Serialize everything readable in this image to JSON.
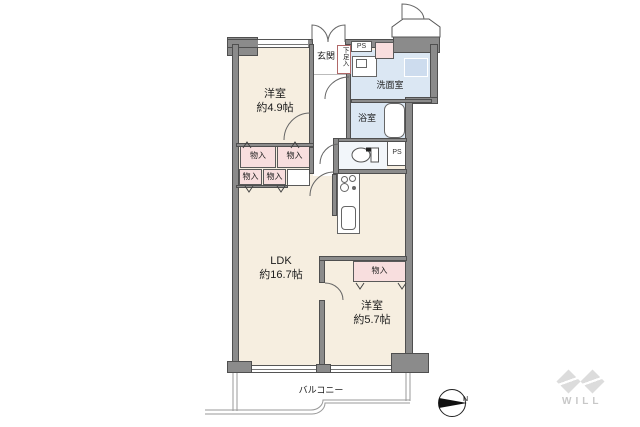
{
  "labels": {
    "room1_name": "洋室",
    "room1_size": "約4.9帖",
    "ldk_name": "LDK",
    "ldk_size": "約16.7帖",
    "room2_name": "洋室",
    "room2_size": "約5.7帖",
    "genkan": "玄関",
    "shoe_box": "下足入",
    "washroom": "洗面室",
    "bathroom": "浴室",
    "storage": "物入",
    "ps": "PS",
    "mb_ps": "MB PS",
    "balcony": "バルコニー",
    "compass_north": "N",
    "brand": "WILL"
  },
  "colors": {
    "floor": "#f6eee0",
    "wet_area": "#dbe7f3",
    "storage_box": "#f8dede",
    "wall": "#8b8b8b",
    "wall_edge": "#4f4f4f",
    "logo": "#dcdcdc",
    "text": "#1c1c1c"
  }
}
